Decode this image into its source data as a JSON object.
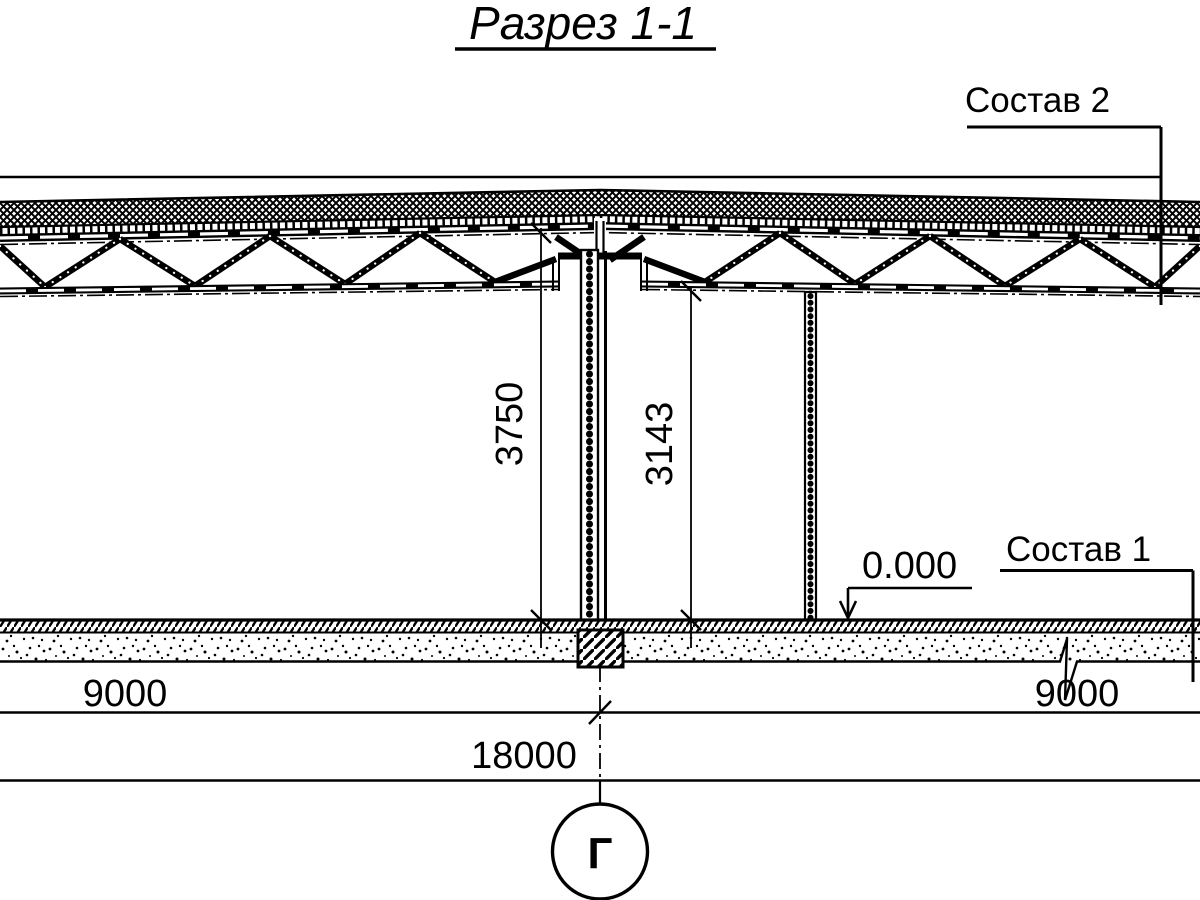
{
  "title": "Разрез 1-1",
  "annotations": {
    "roof_composition": "Состав 2",
    "floor_composition": "Состав 1",
    "floor_elevation": "0.000",
    "axis_label": "Г"
  },
  "dimensions": {
    "height_floor_to_top_chord": "3750",
    "height_floor_to_bottom_chord": "3143",
    "span_left": "9000",
    "span_right": "9000",
    "total_span": "18000"
  },
  "colors": {
    "ink": "#000000",
    "paper": "#ffffff"
  }
}
